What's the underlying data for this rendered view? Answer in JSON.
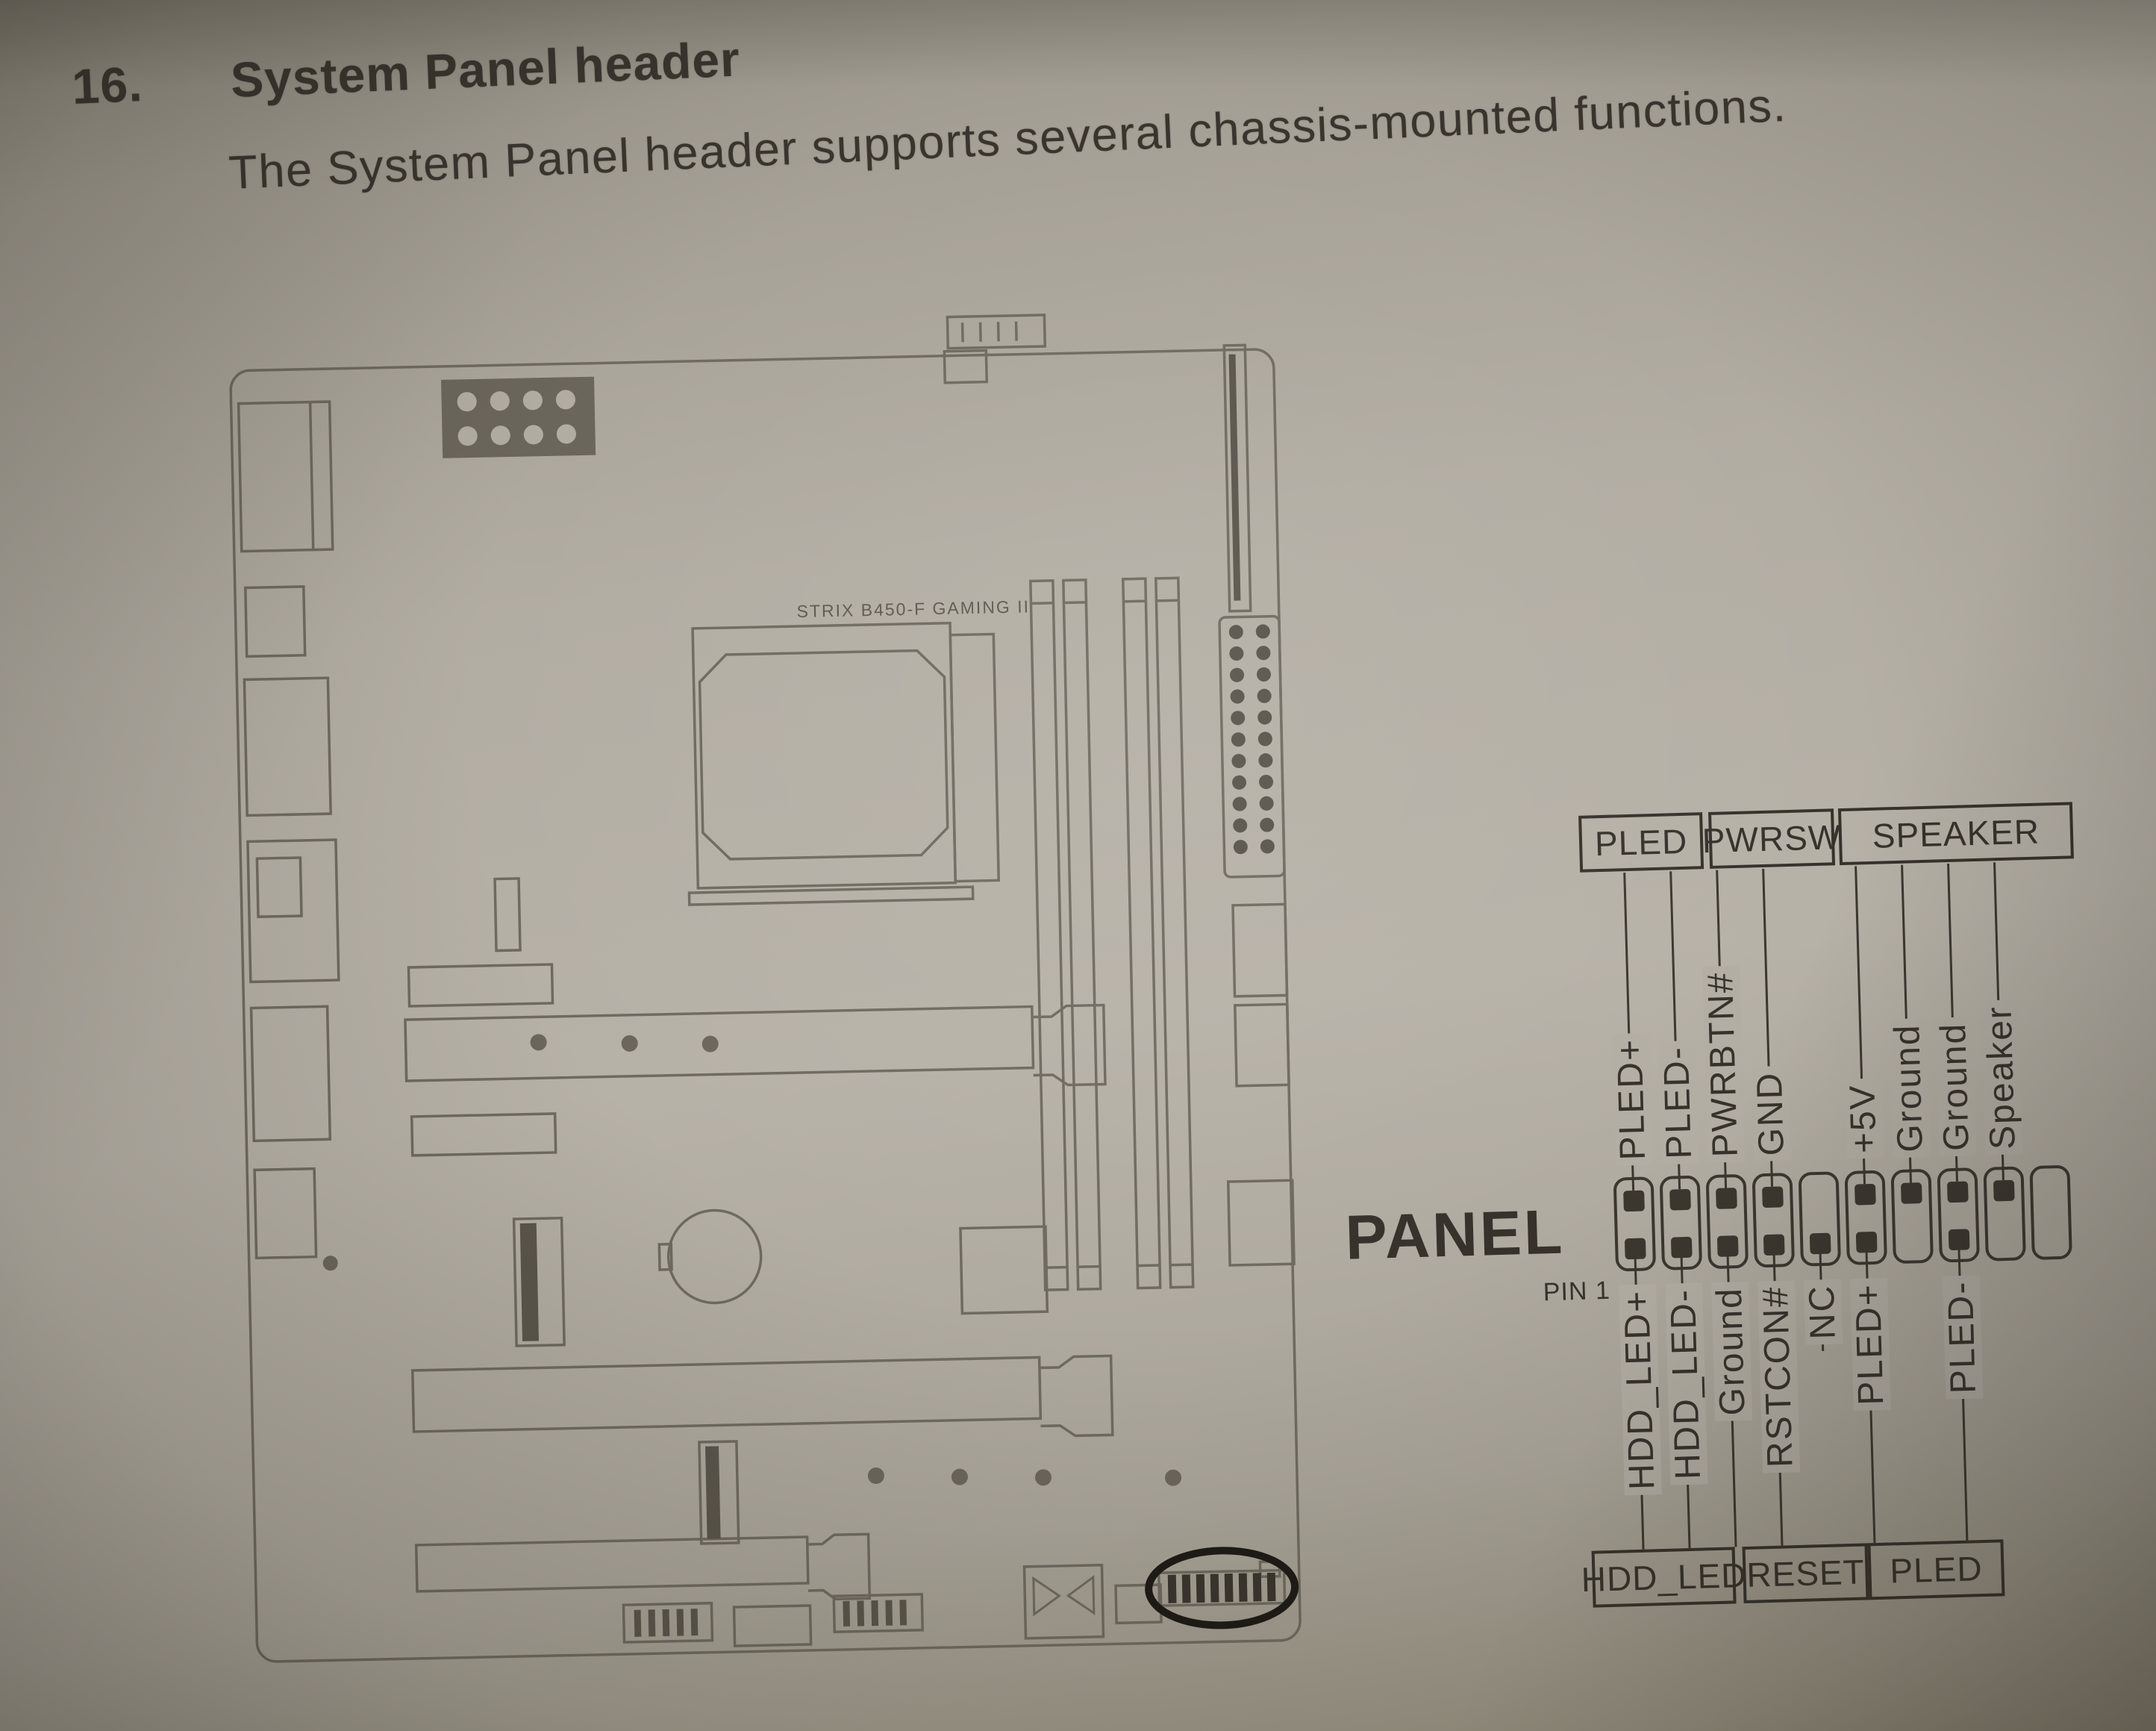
{
  "document": {
    "section_number": "16.",
    "title": "System Panel header",
    "description": "The System Panel header supports several chassis-mounted functions."
  },
  "motherboard": {
    "model_label": "STRIX B450-F GAMING II"
  },
  "panel_diagram": {
    "connector_label": "PANEL",
    "pin1_label": "PIN 1",
    "top_groups": {
      "pled": "PLED",
      "pwrsw": "PWRSW",
      "speaker": "SPEAKER"
    },
    "bottom_groups": {
      "hdd_led": "HDD_LED",
      "reset": "RESET",
      "pled": "PLED"
    },
    "top_pins": [
      "PLED+",
      "PLED-",
      "PWRBTN#",
      "GND",
      "",
      "+5V",
      "Ground",
      "Ground",
      "Speaker",
      ""
    ],
    "bottom_pins": [
      "HDD_LED+",
      "HDD_LED-",
      "Ground",
      "RSTCON#",
      "NC",
      "PLED+",
      "",
      "PLED-",
      "",
      ""
    ]
  },
  "colors": {
    "paper": "#b4afa5",
    "ink": "#39352e",
    "board_line": "#6f6a60",
    "highlight_ellipse": "#1d1a16"
  }
}
